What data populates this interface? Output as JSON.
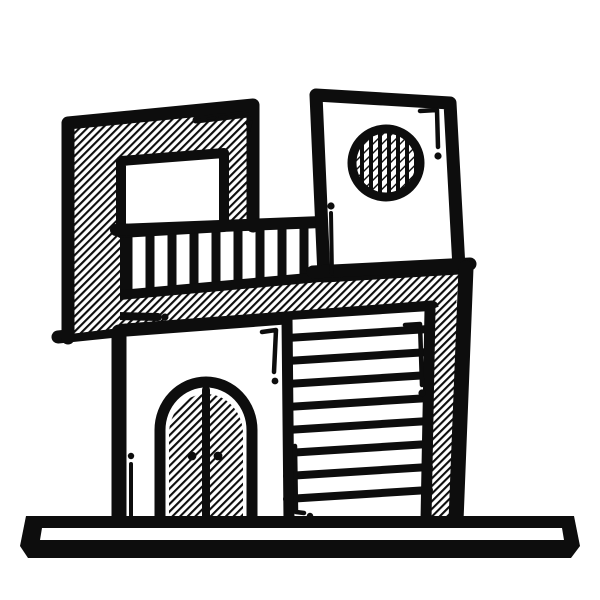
{
  "meta": {
    "type": "illustration",
    "subject": "modern two-story house, hand-drawn doodle style",
    "style": "black ink outline with diagonal hatching fills, no text",
    "orientation": "building tilts slightly, sitting on a flat ground slab"
  },
  "colors": {
    "ink": "#0d0d0d",
    "paper": "#ffffff"
  },
  "elements": {
    "ground_platform": "long flat base slab under the house",
    "upper_left_wall": "hatched upper wall panel with rectangular window",
    "window": "white rectangular window in hatched panel",
    "balcony_railing": "horizontal rails with vertical balusters",
    "second_floor_slab": "hatched band separating floors",
    "tower": "white tower block with round vent",
    "round_vent": "circular vent with vertical louvers and diagonal hatch",
    "front_door": "arched double door with diagonal hatching and two round handles",
    "garage_door": "wide door with horizontal slats",
    "side_strip": "hatched vertical strip on right wall",
    "doodle_marks": "small accent lines and dots (brackets, exclamation-like strokes, dashed arrow)"
  }
}
